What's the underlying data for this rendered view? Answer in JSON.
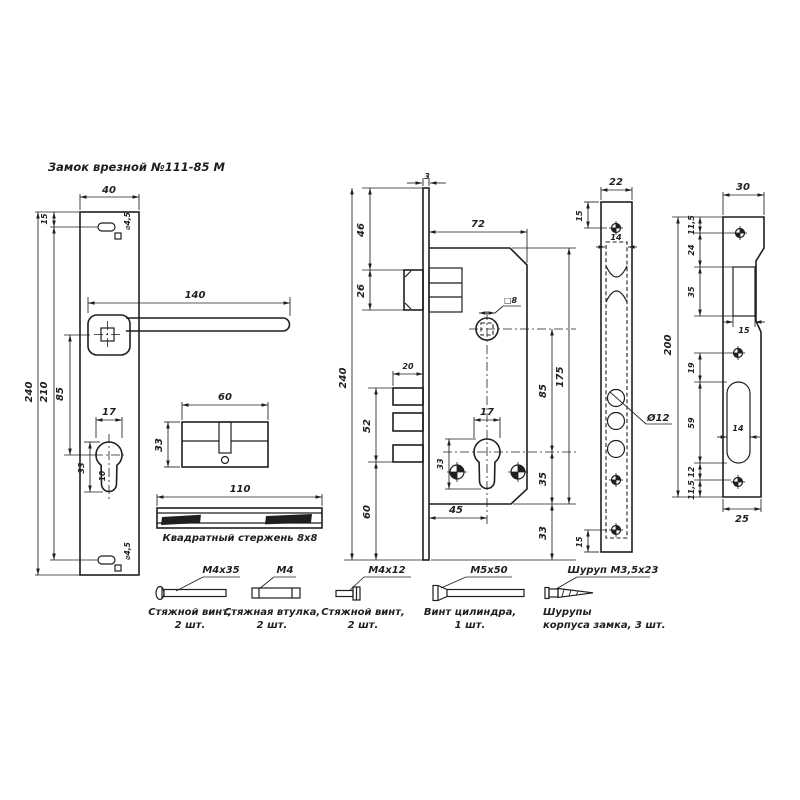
{
  "title": "Замок врезной №111-85 М",
  "handle_plate": {
    "width": "40",
    "top_offset": "15",
    "height": "240",
    "hole_spacing": "210",
    "centers": "85",
    "top_hole": "⌀4,5",
    "bottom_hole": "⌀4,5",
    "handle_length": "140",
    "keyhole_width": "17",
    "keyhole_height": "33",
    "keyhole_slot": "10"
  },
  "cylinder": {
    "length": "60",
    "height": "33"
  },
  "square_rod": {
    "length": "110",
    "caption": "Квадратный стержень 8х8"
  },
  "lock_body": {
    "faceplate_thickness": "3",
    "top_to_latch": "46",
    "latch_height": "26",
    "height": "240",
    "depth": "72",
    "spindle": "□8",
    "bolt_throw": "20",
    "bolt_zone": "52",
    "bottom": "60",
    "cyl_width": "17",
    "cyl_height": "33",
    "centers": "85",
    "case_height": "175",
    "cyl_to_bottom": "35",
    "backset": "45",
    "end": "33"
  },
  "faceplate": {
    "width": "22",
    "top_screw": "15",
    "inner_width": "14",
    "hole_dia": "Ø12",
    "bottom_screw": "15"
  },
  "strike_plate": {
    "width": "30",
    "height": "200",
    "top_hole": "11,5",
    "hole_to_opening": "24",
    "opening_height": "35",
    "opening_width": "15",
    "to_slot": "19",
    "slot_height": "59",
    "slot_width": "14",
    "slot_to_hole": "12",
    "bottom_hole": "11,5",
    "bottom_width": "25"
  },
  "fasteners": [
    {
      "size": "M4x35",
      "name": "Стяжной винт,",
      "qty": "2 шт."
    },
    {
      "size": "M4",
      "name": "Стяжная втулка,",
      "qty": "2 шт."
    },
    {
      "size": "M4x12",
      "name": "Стяжной винт,",
      "qty": "2 шт."
    },
    {
      "size": "M5x50",
      "name": "Винт цилиндра,",
      "qty": "1 шт."
    },
    {
      "size": "Шуруп М3,5х23",
      "name": "Шурупы",
      "qty": "корпуса замка, 3 шт."
    }
  ],
  "colors": {
    "ink": "#1f1f1f",
    "paper": "#ffffff"
  }
}
